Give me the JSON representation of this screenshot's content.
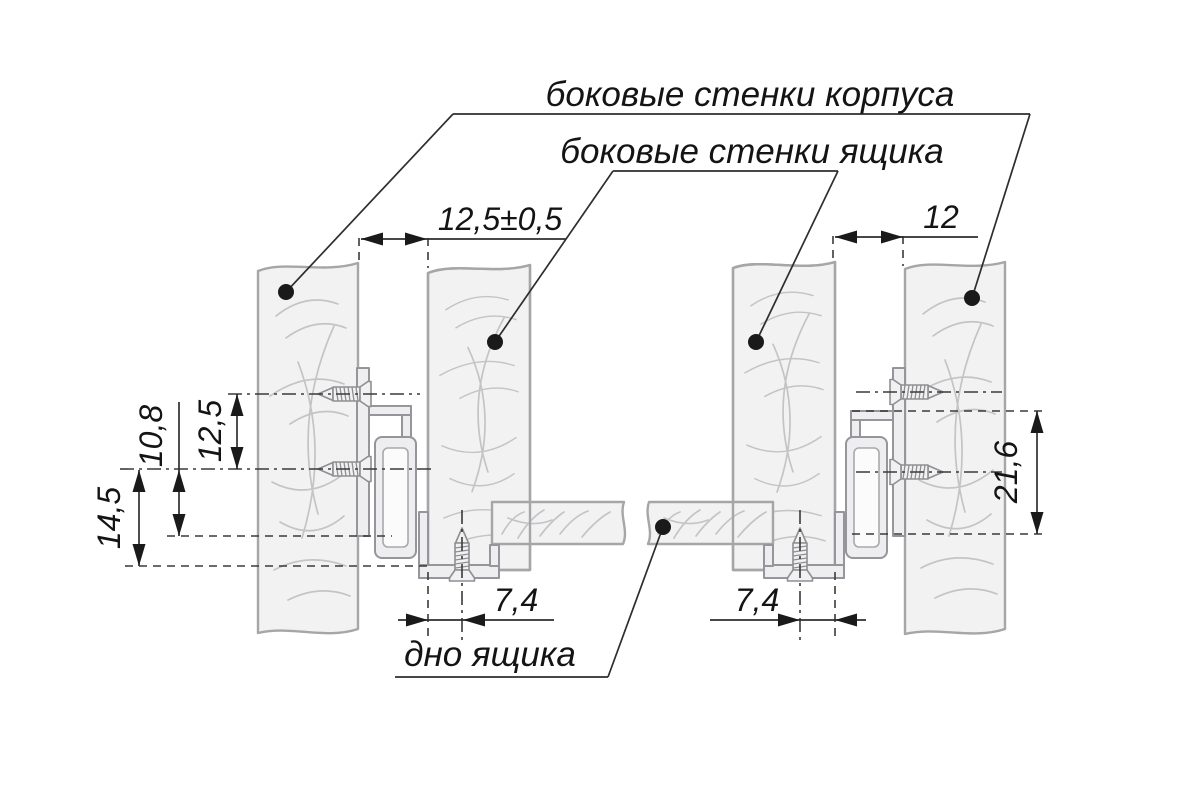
{
  "drawing": {
    "labels": {
      "cabinet_walls": "боковые стенки корпуса",
      "drawer_walls": "боковые стенки ящика",
      "drawer_bottom": "дно ящика"
    },
    "dimensions": {
      "gap_left": "12,5±0,5",
      "gap_right": "12",
      "screw_pitch": "12,5",
      "rail_drop": "10,8",
      "rail_bottom_offset": "14,5",
      "rail_height": "21,6",
      "bottom_screw_inset_left": "7,4",
      "bottom_screw_inset_right": "7,4"
    },
    "colors": {
      "background": "#ffffff",
      "panel_fill": "#f2f2f3",
      "panel_stroke": "#a6a6a8",
      "metal_stroke": "#95959a",
      "line": "#2e2e2e",
      "text": "#141414"
    }
  }
}
